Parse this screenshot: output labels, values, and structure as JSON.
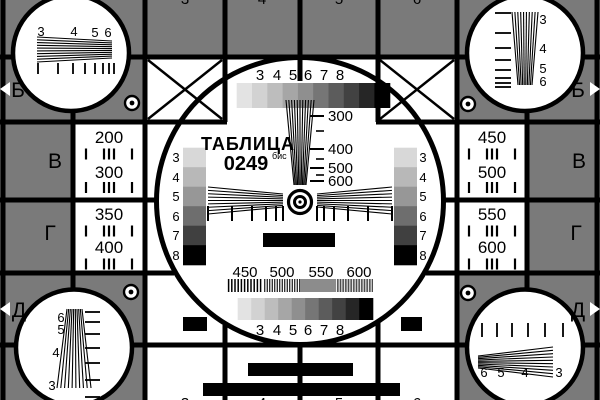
{
  "colors": {
    "background": "#7a7a7a",
    "paper": "#ffffff",
    "ink": "#000000"
  },
  "title": {
    "name": "ТАБЛИЦА",
    "number": "0249",
    "suffix": "бис"
  },
  "row_letters": {
    "left": [
      "Б",
      "В",
      "Г",
      "Д"
    ],
    "right": [
      "Б",
      "В",
      "Г",
      "Д"
    ]
  },
  "column_digits": [
    "3",
    "4",
    "5",
    "6"
  ],
  "left_panel": {
    "cell1": [
      "200",
      "300"
    ],
    "cell2": [
      "350",
      "400"
    ]
  },
  "right_panel": {
    "cell1": [
      "450",
      "500"
    ],
    "cell2": [
      "550",
      "600"
    ]
  },
  "center_scale": {
    "labels": [
      "300",
      "400",
      "500",
      "600"
    ]
  },
  "step_labels": [
    "3",
    "4",
    "5",
    "6",
    "7",
    "8"
  ],
  "frequency_labels": [
    "450",
    "500",
    "550",
    "600"
  ],
  "wedges": {
    "top_left": [
      "3",
      "4",
      "5",
      "6"
    ],
    "top_right": [
      "3",
      "4",
      "5",
      "6"
    ],
    "bottom_left": [
      "6",
      "5",
      "4",
      "3"
    ],
    "bottom_right": [
      "6",
      "5",
      "4",
      "3"
    ]
  },
  "grayscale_steps_10": [
    "#e3e3e3",
    "#d2d2d2",
    "#bdbdbd",
    "#a6a6a6",
    "#8f8f8f",
    "#767676",
    "#5c5c5c",
    "#424242",
    "#262626",
    "#000000"
  ],
  "grayscale_steps_6": [
    "#d8d8d8",
    "#b8b8b8",
    "#979797",
    "#6e6e6e",
    "#404040",
    "#000000"
  ]
}
